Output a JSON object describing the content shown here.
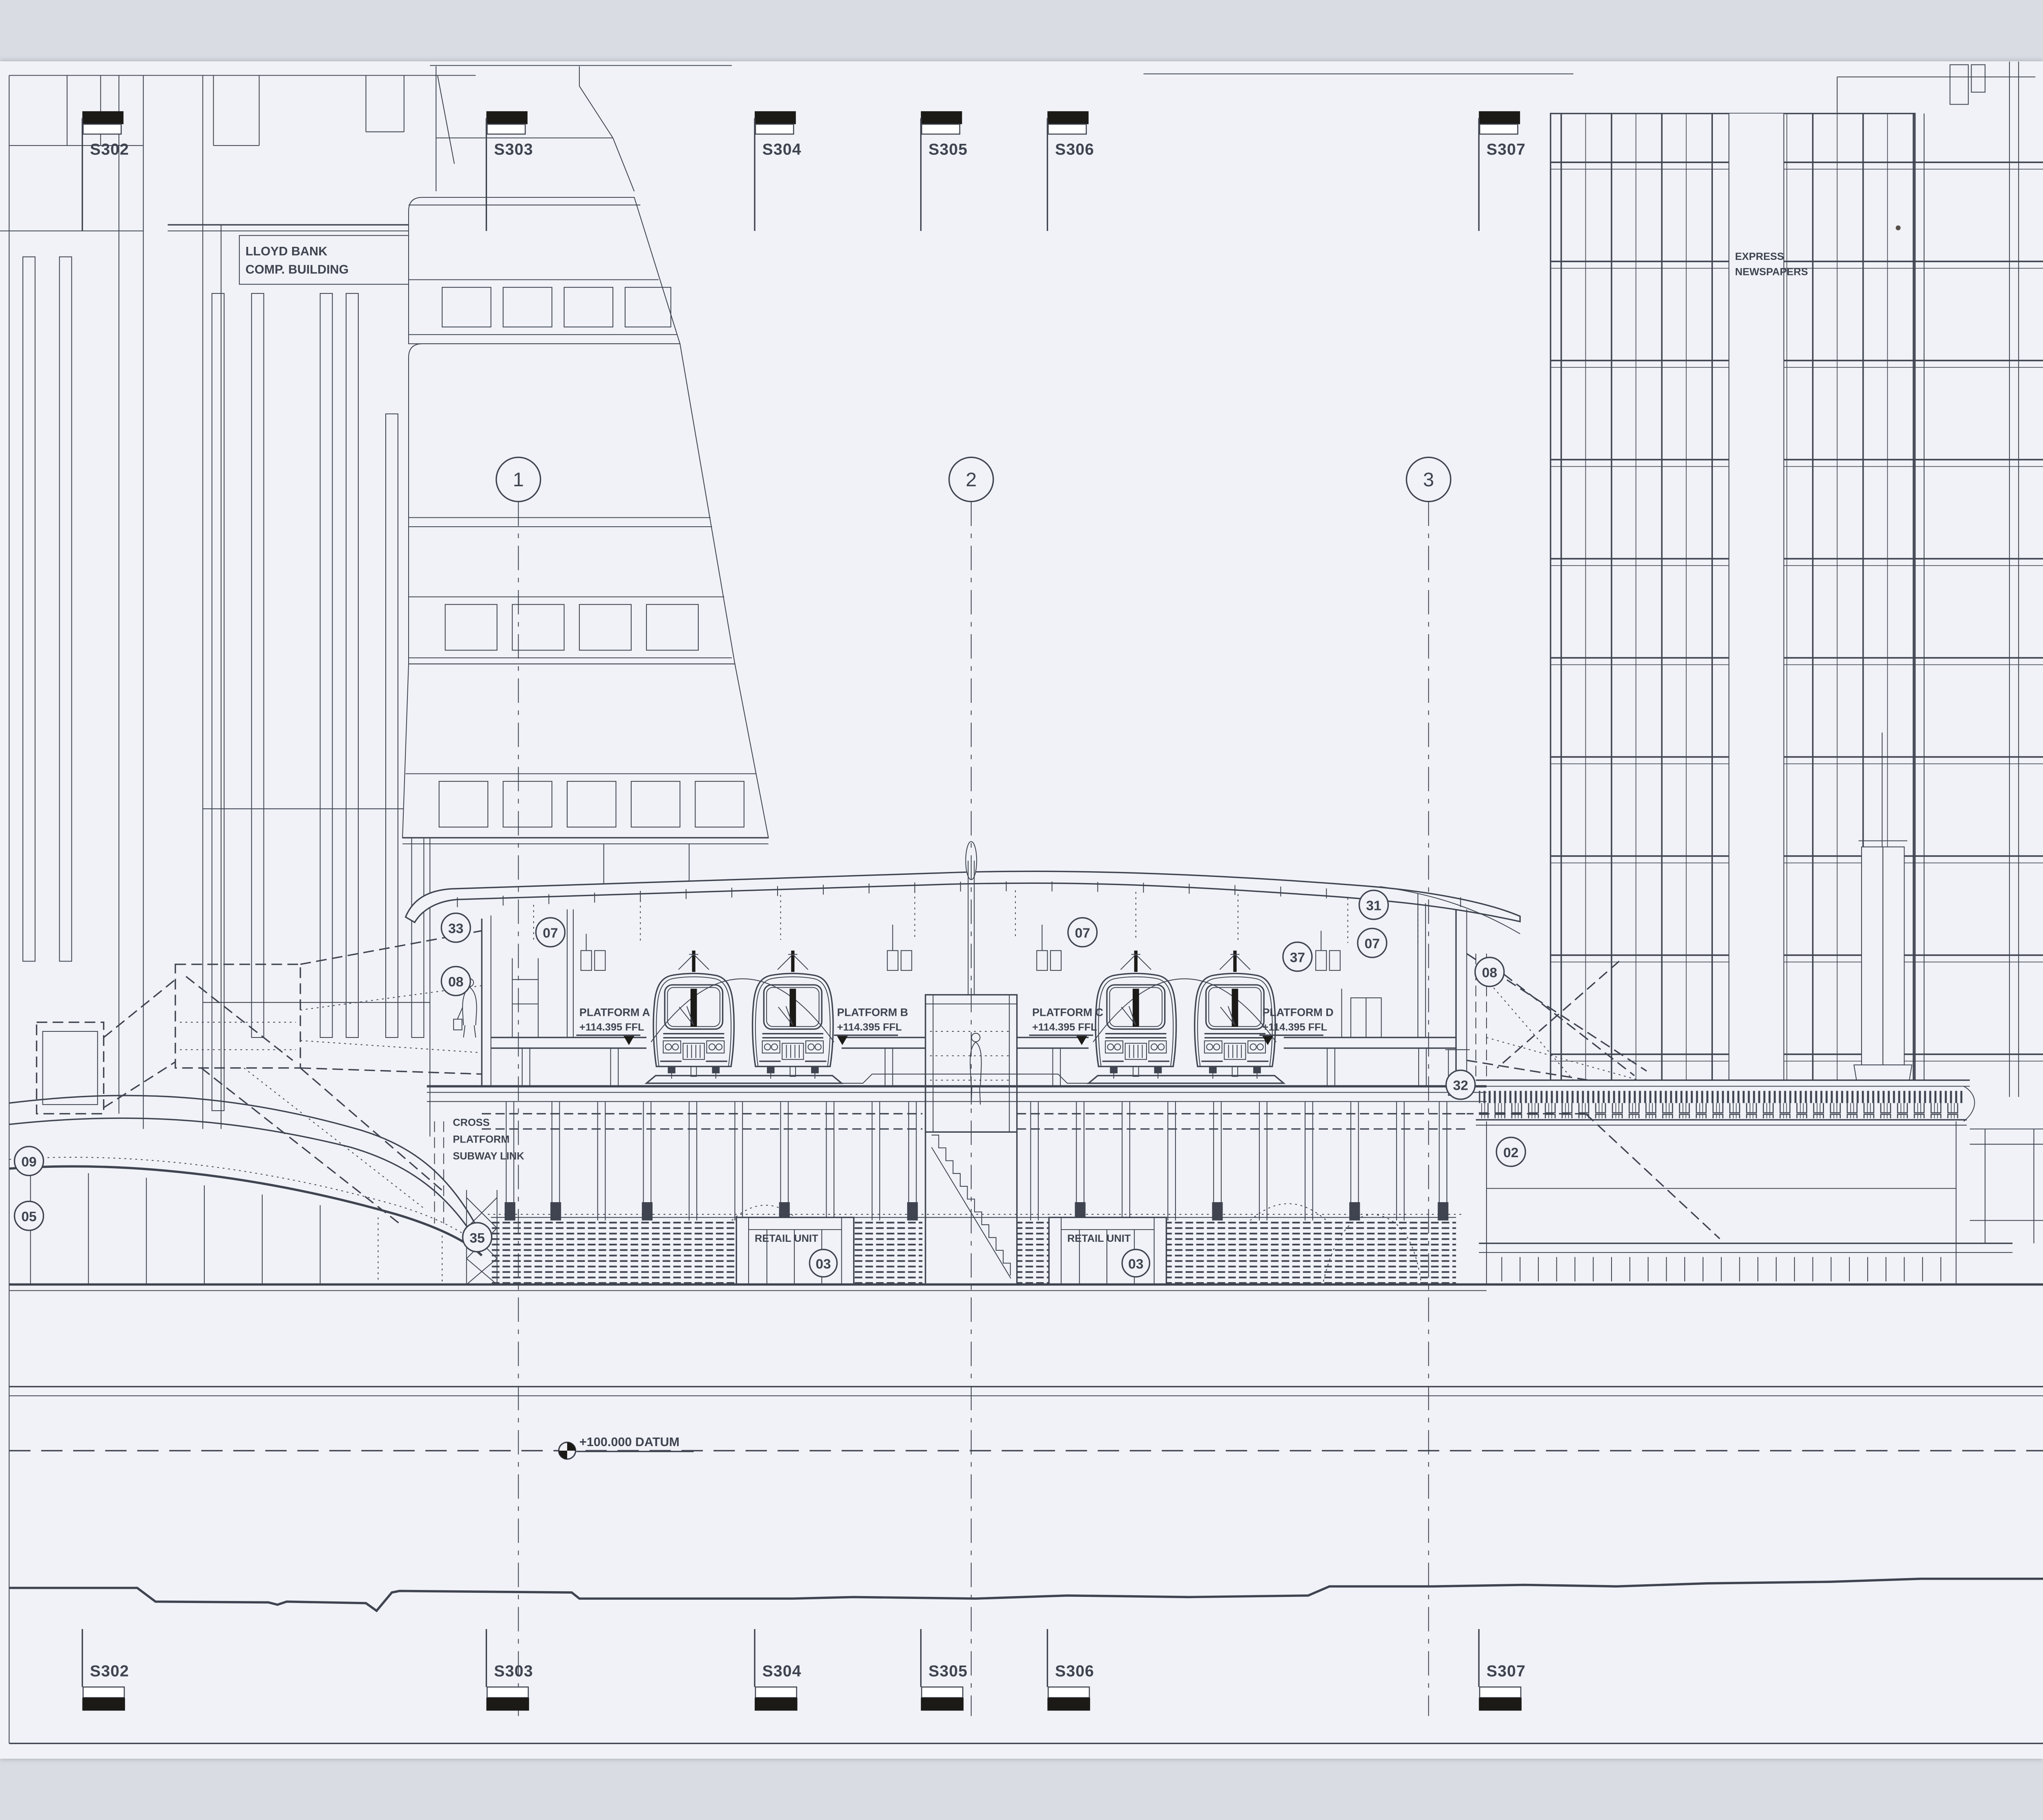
{
  "drawing": {
    "colors": {
      "paper": "#f0f2f7",
      "ink": "#3f4450",
      "inkdark": "#1c1a17"
    },
    "buildings": {
      "lloyd_bank": {
        "line1": "LLOYD BANK",
        "line2": "COMP. BUILDING"
      },
      "express": {
        "line1": "EXPRESS",
        "line2": "NEWSPAPERS"
      }
    },
    "grid": {
      "bubbles": [
        "1",
        "2",
        "3"
      ],
      "sections_top": [
        "S302",
        "S303",
        "S304",
        "S305",
        "S306",
        "S307"
      ],
      "sections_bottom": [
        "S302",
        "S303",
        "S304",
        "S305",
        "S306",
        "S307"
      ]
    },
    "platforms": [
      {
        "name": "PLATFORM A",
        "level": "+114.395 FFL"
      },
      {
        "name": "PLATFORM B",
        "level": "+114.395 FFL"
      },
      {
        "name": "PLATFORM C",
        "level": "+114.395 FFL"
      },
      {
        "name": "PLATFORM D",
        "level": "+114.395 FFL"
      }
    ],
    "annotations": {
      "datum": "+100.000 DATUM",
      "cross_platform_link": {
        "line1": "CROSS",
        "line2": "PLATFORM",
        "line3": "SUBWAY LINK"
      },
      "retail_unit": "RETAIL UNIT"
    },
    "refs": [
      "33",
      "07",
      "07",
      "07",
      "08",
      "08",
      "31",
      "37",
      "32",
      "02",
      "09",
      "05",
      "35",
      "03",
      "03"
    ]
  }
}
